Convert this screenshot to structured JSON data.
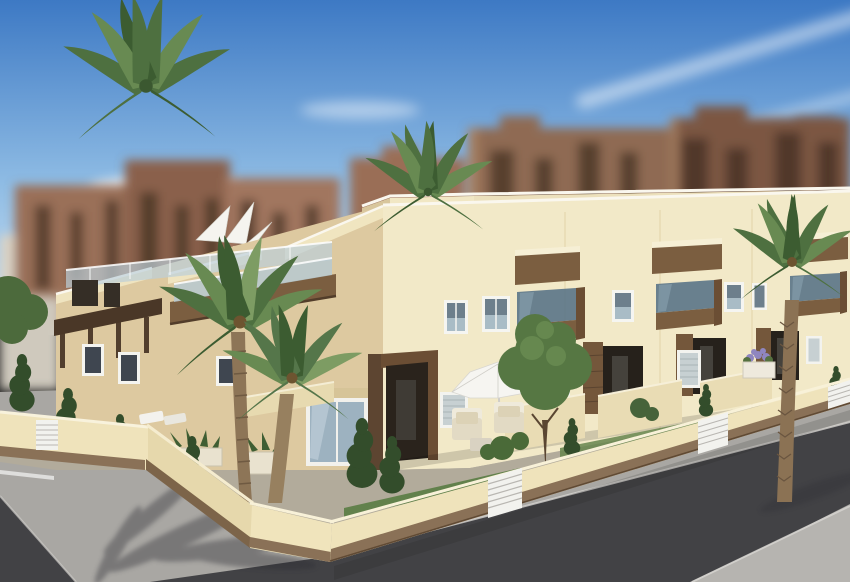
{
  "scene": {
    "type": "3d-architectural-rendering",
    "subject": "Modern two-storey cream townhouse development on a street corner with roof terraces, wood-trimmed balconies, glass railings, palm trees and a walled front garden",
    "background": "Blurred red-brown high-rise apartment blocks under a blue sky with wispy clouds",
    "foreground": "Grey sidewalks and dark asphalt streets meeting at the corner, with palm shadows"
  },
  "palette": {
    "sky_top": "#3d79c4",
    "sky_mid": "#8fbce4",
    "sky_horizon": "#d3e4f3",
    "cloud": "#ffffff",
    "bg_block_warm": "#9a6e56",
    "bg_block_dark": "#7c5743",
    "bg_block_light": "#a1765e",
    "bg_window": "#42301f",
    "bg_pale": "#d9d2c4",
    "facade_sunlit": "#f2e9c8",
    "facade_shaded": "#ddc9a0",
    "facade_rear": "#ece0bc",
    "gable_light": "#efe4c0",
    "parapet_cap": "#faf7ee",
    "wood": "#7b5e40",
    "wood_dark": "#4a3727",
    "wood_pillar": "#6b4e34",
    "glass_railing": "#bccfd8",
    "glass_tinted": "#5d7689",
    "glass_window": "#9db2c0",
    "window_frame": "#f5f5f1",
    "recess": "#2a231c",
    "shutter": "#c7d0d2",
    "wall_cream": "#efe3bb",
    "wall_shaded": "#e6d8ac",
    "wall_base": "#8a7157",
    "gate_white": "#f2f2ee",
    "courtyard": "#b2ab9b",
    "lawn": "#5e7e48",
    "sidewalk": "#a9a7a3",
    "sidewalk_far": "#b6b4b0",
    "road": "#424245",
    "curb": "#d8d6d2",
    "conifer": "#334d2b",
    "palm_green": "#4e7040",
    "palm_light": "#688a52",
    "leafy": "#567743",
    "trunk": "#8d7557",
    "parasol": "#f5f4ef",
    "cushion": "#dcd2b6",
    "shadow": "#2c2c30",
    "flower": "#8f86c0"
  }
}
